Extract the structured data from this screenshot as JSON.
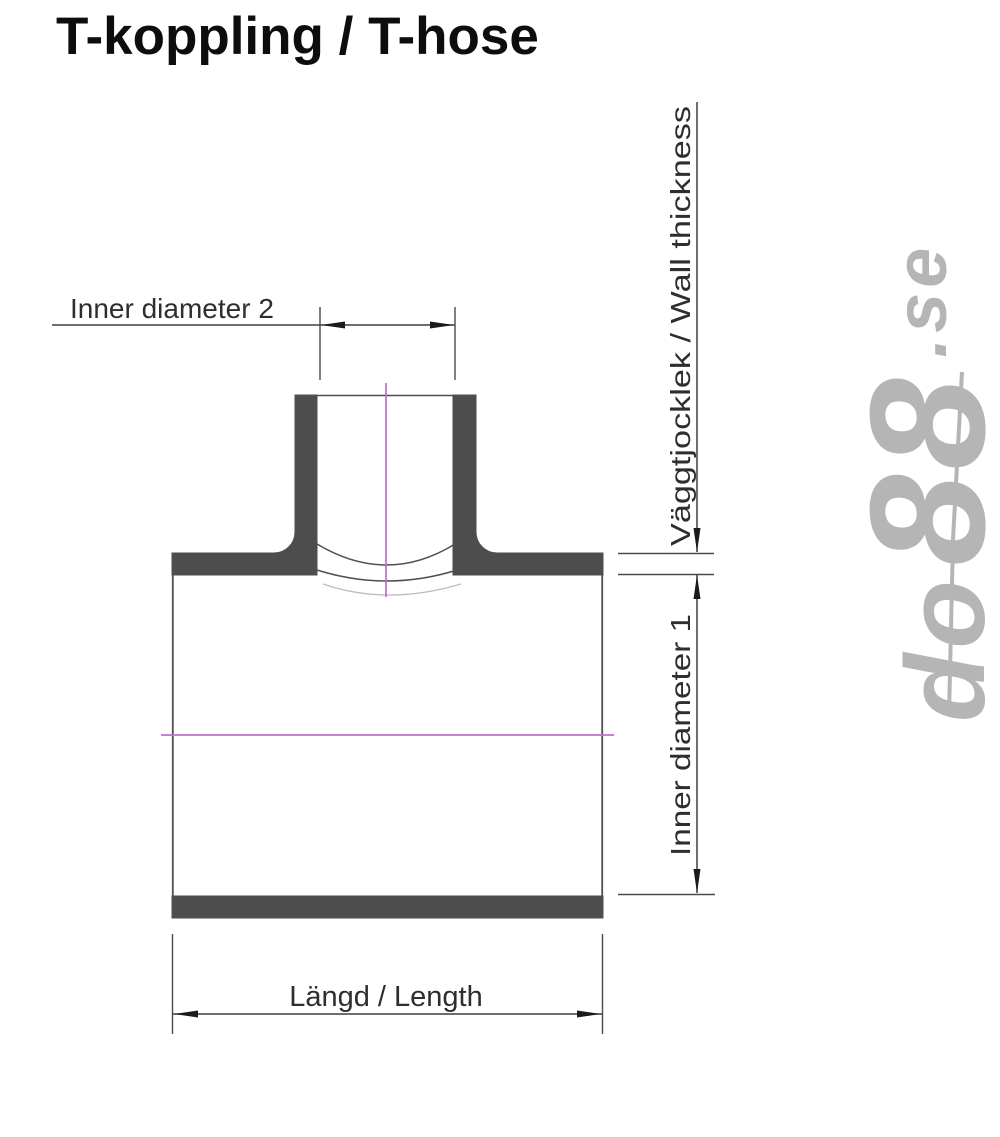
{
  "title": "T-koppling / T-hose",
  "watermark": {
    "brand_do": "do",
    "brand_88": "88",
    "tld": ".se",
    "color": "#b5b5b5"
  },
  "diagram": {
    "labels": {
      "inner_diameter_2": "Inner diameter 2",
      "wall_thickness": "Väggtjocklek / Wall thickness",
      "inner_diameter_1": "Inner diameter 1",
      "length": "Längd / Length"
    },
    "colors": {
      "wall_fill": "#4d4d4d",
      "outline": "#4f4f4f",
      "dimension_line": "#3f3f3f",
      "arrow": "#1b1b1b",
      "centerline": "#bb70c9",
      "hidden_edge": "#bdbdbd",
      "label_text": "#2e2e2e",
      "background": "#ffffff"
    }
  }
}
